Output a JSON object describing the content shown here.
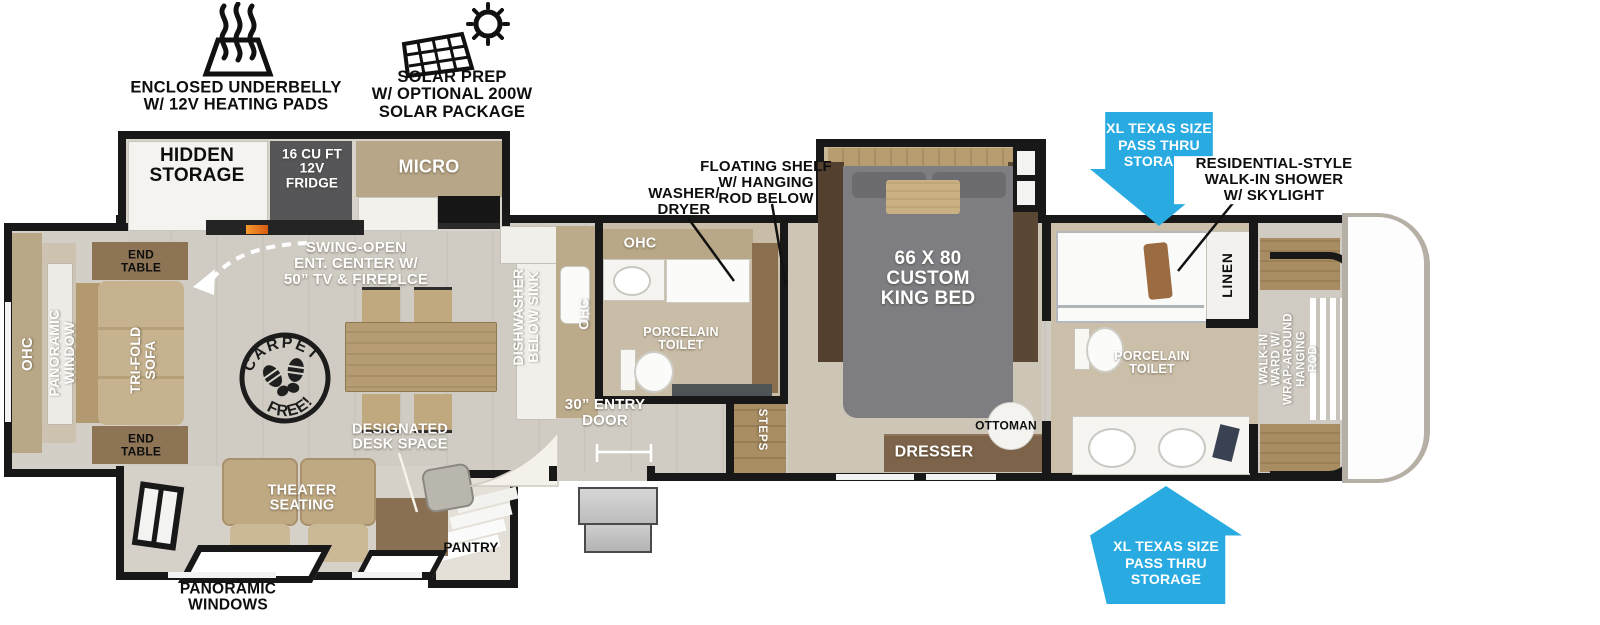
{
  "features": {
    "underbelly": "ENCLOSED UNDERBELLY\nW/ 12V HEATING PADS",
    "solar": "SOLAR PREP\nW/ OPTIONAL 200W\nSOLAR PACKAGE"
  },
  "callouts": {
    "washer_dryer": "WASHER/\nDRYER",
    "floating_shelf": "FLOATING SHELF\nW/ HANGING\nROD BELOW",
    "shower": "RESIDENTIAL-STYLE\nWALK-IN SHOWER\nW/ SKYLIGHT",
    "pass_thru_top": "XL TEXAS SIZE\nPASS THRU\nSTORAGE",
    "pass_thru_bottom": "XL TEXAS SIZE\nPASS THRU\nSTORAGE",
    "panoramic_windows": "PANORAMIC\nWINDOWS"
  },
  "rooms": {
    "hidden_storage": "HIDDEN\nSTORAGE",
    "fridge": "16 CU FT\n12V\nFRIDGE",
    "micro": "MICRO",
    "swing_open": "SWING-OPEN\nENT. CENTER W/\n50” TV & FIREPLCE",
    "end_table_top": "END\nTABLE",
    "end_table_bottom": "END\nTABLE",
    "ohc_sofa": "OHC",
    "panoramic_window": "PANORAMIC\nWINDOW",
    "trifold_sofa": "TRI-FOLD\nSOFA",
    "carpet_free_top": "CARPET",
    "carpet_free_bottom": "FREE!",
    "dishwasher": "DISHWASHER\nBELOW SINK",
    "ohc_kitchen": "OHC",
    "ohc_bath": "OHC",
    "toilet_mid": "PORCELAIN\nTOILET",
    "entry_door": "30” ENTRY\nDOOR",
    "steps": "STEPS",
    "king_bed": "66 X 80\nCUSTOM\nKING BED",
    "dresser": "DRESSER",
    "ottoman": "OTTOMAN",
    "linen": "LINEN",
    "toilet_front": "PORCELAIN\nTOILET",
    "walk_in_ward": "WALK-IN\nWARD W/\nWRAP-AROUND\nHANGING\nROD",
    "desk": "DESIGNATED\nDESK SPACE",
    "theater": "THEATER\nSEATING",
    "pantry": "PANTRY"
  },
  "colors": {
    "accent_blue": "#29ABE2",
    "wall": "#181818",
    "floor": "#d0ccc3"
  }
}
